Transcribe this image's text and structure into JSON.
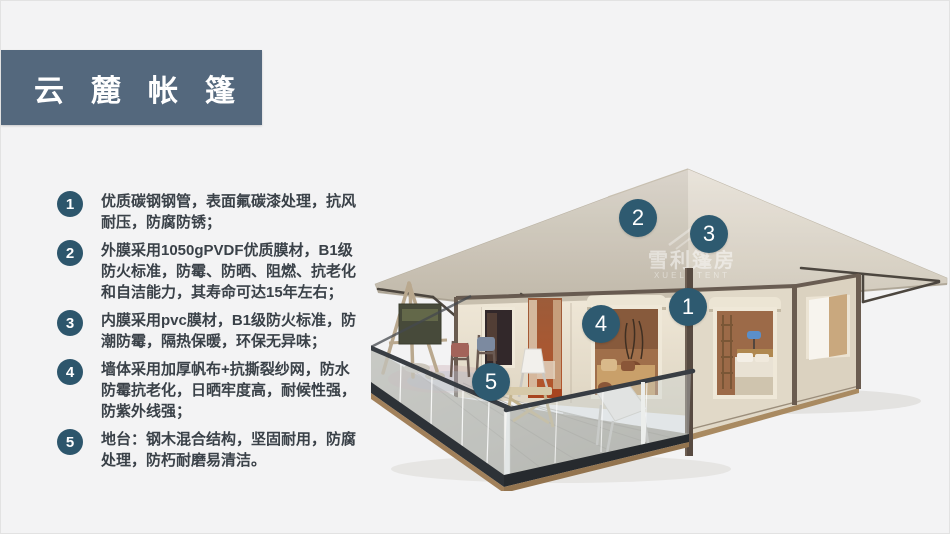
{
  "header": {
    "title": "云麓帐篷"
  },
  "features": [
    {
      "num": "1",
      "text": "优质碳钢钢管，表面氟碳漆处理，抗风耐压，防腐防锈；"
    },
    {
      "num": "2",
      "text": "外膜采用1050gPVDF优质膜材，B1级防火标准，防霉、防晒、阻燃、抗老化和自洁能力，其寿命可达15年左右；"
    },
    {
      "num": "3",
      "text": "内膜采用pvc膜材，B1级防火标准，防潮防霉，隔热保暖，环保无异味；"
    },
    {
      "num": "4",
      "text": "墙体采用加厚帆布+抗撕裂纱网，防水防霉抗老化，日晒牢度高，耐候性强，防紫外线强；"
    },
    {
      "num": "5",
      "text": "地台：钢木混合结构，坚固耐用，防腐处理，防朽耐磨易清洁。"
    }
  ],
  "callouts": [
    {
      "num": "1"
    },
    {
      "num": "2"
    },
    {
      "num": "3"
    },
    {
      "num": "4"
    },
    {
      "num": "5"
    }
  ],
  "watermark": {
    "cn": "雪利篷房",
    "en": "XUELI TENT"
  },
  "colors": {
    "banner_bg": "#54687d",
    "badge_bg": "#2d566c",
    "callout_bg": "#2e5a70",
    "text": "#3a4148",
    "page_bg": "#f3f3f4",
    "roof": "#d8d1c4",
    "wall": "#e8e0cf"
  }
}
